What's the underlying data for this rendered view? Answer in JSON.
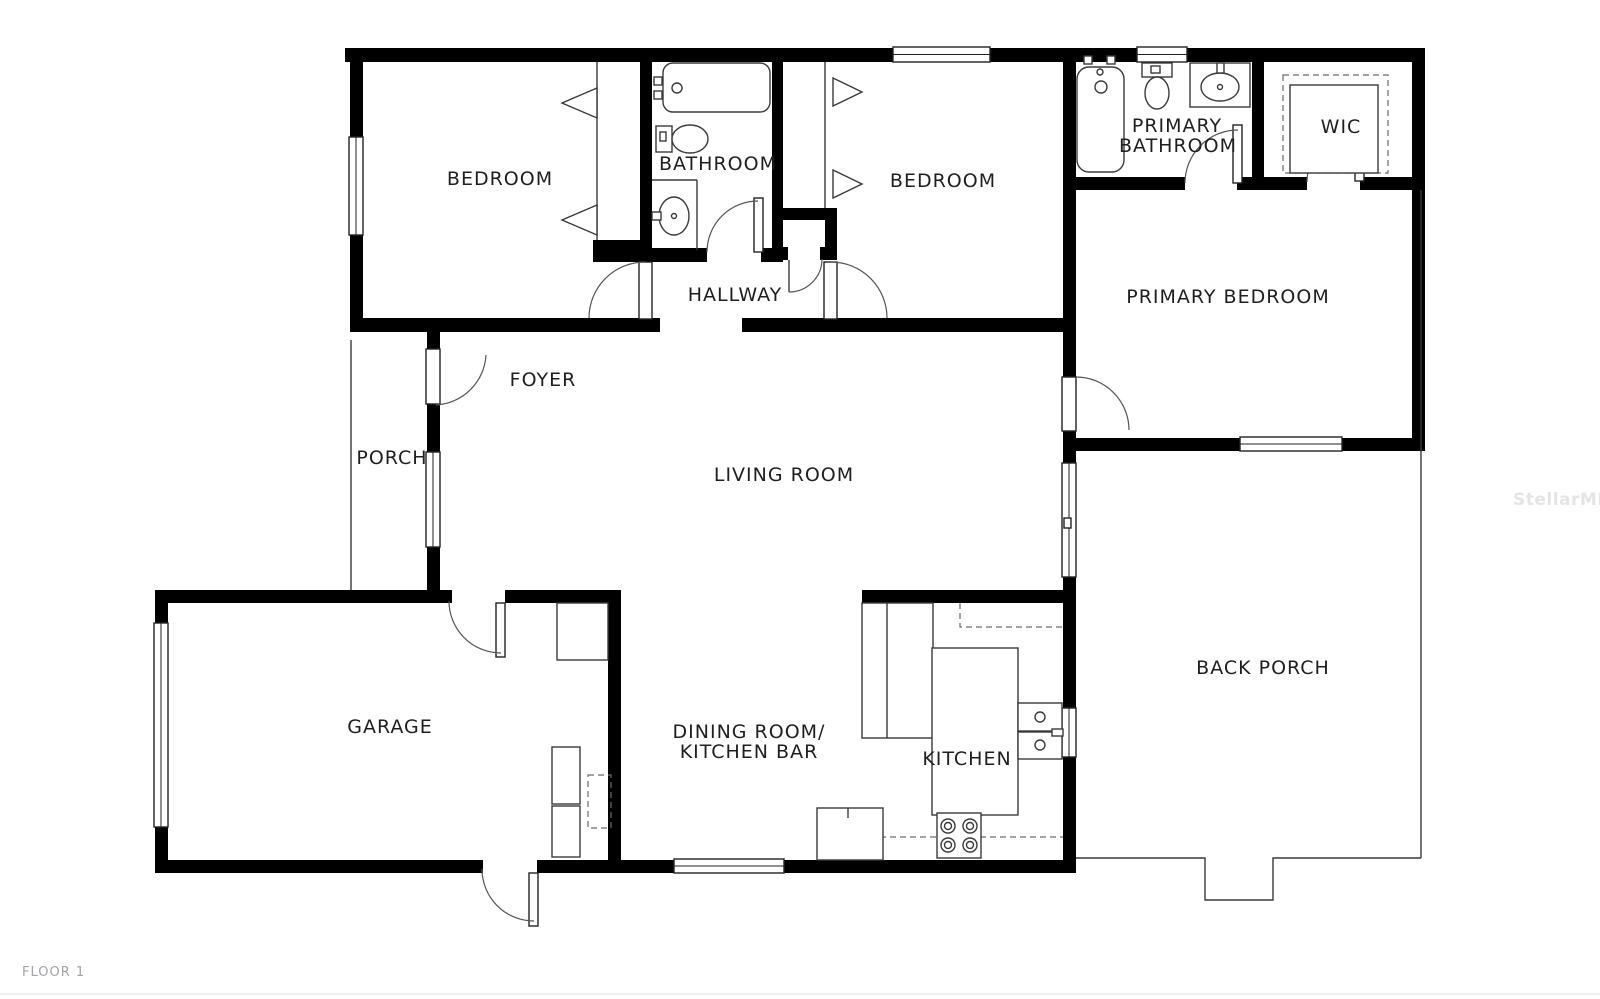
{
  "page": {
    "floor_label": "FLOOR 1",
    "watermark": "StellarMLS",
    "background": "#ffffff"
  },
  "colors": {
    "wall": "#000000",
    "thin_line": "#3a3a3a",
    "room_label": "#1f1f1f",
    "muted_label": "#a3a3a8",
    "watermark": "#e4e4e6"
  },
  "rooms": {
    "bedroom_top_left": {
      "label": "BEDROOM"
    },
    "hall_bathroom": {
      "label": "BATHROOM"
    },
    "bedroom_middle": {
      "label": "BEDROOM"
    },
    "primary_bathroom": {
      "label_line1": "PRIMARY",
      "label_line2": "BATHROOM"
    },
    "walk_in_closet": {
      "label": "WIC"
    },
    "primary_bedroom": {
      "label": "PRIMARY BEDROOM"
    },
    "hallway": {
      "label": "HALLWAY"
    },
    "foyer": {
      "label": "FOYER"
    },
    "porch": {
      "label": "PORCH"
    },
    "living_room": {
      "label": "LIVING ROOM"
    },
    "garage": {
      "label": "GARAGE"
    },
    "dining_room": {
      "label_line1": "DINING ROOM/",
      "label_line2": "KITCHEN BAR"
    },
    "kitchen": {
      "label": "KITCHEN"
    },
    "back_porch": {
      "label": "BACK PORCH"
    }
  },
  "icons": {
    "bathtub-icon": "rounded-rect-outline-with-faucet",
    "toilet-icon": "tank-and-bowl-outline",
    "bathroom-sink-icon": "oval-basin-in-vanity",
    "kitchen-sink-icon": "double-square-basins",
    "stove-icon": "square-with-four-burner-circles",
    "refrigerator-icon": "split-tall-rectangle",
    "kitchen-counter-icon": "thin-rect-outline",
    "washer-dryer-icon": "stacked-thin-squares",
    "water-heater-icon": "dashed-square",
    "closet-rod-icon": "triangle-hanger-chevron",
    "closet-shelf-icon": "dashed-inset-rectangle",
    "door-swing-icon": "quarter-circle-arc",
    "window-icon": "triple-line-rect",
    "sliding-door-icon": "lined-rect-with-handle",
    "garage-door-icon": "thin-panel-in-wall",
    "porch-step-icon": "notched-outline"
  }
}
